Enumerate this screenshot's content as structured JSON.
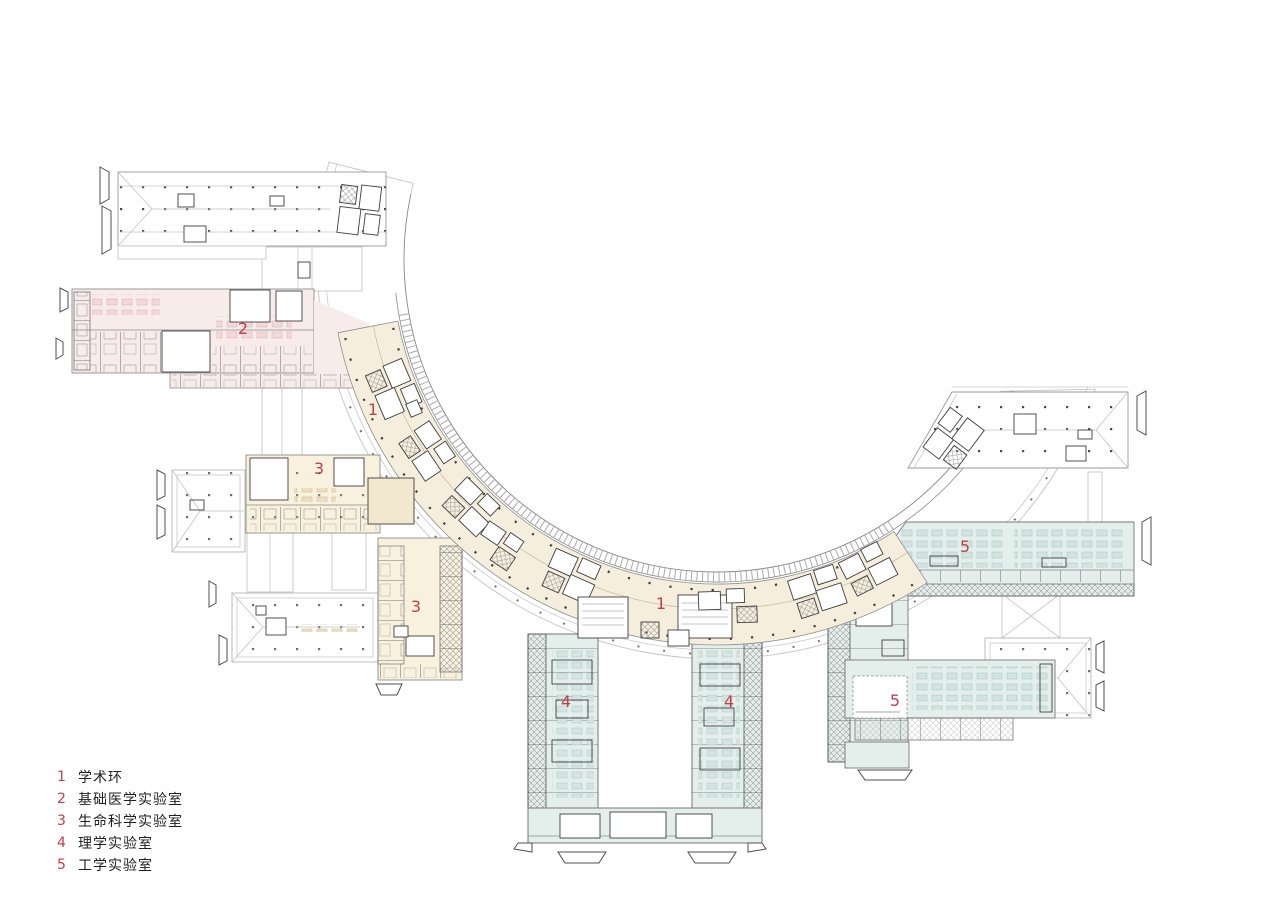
{
  "document": {
    "type": "architectural-floor-plan",
    "description": "campus laboratory complex plan with circular academic ring"
  },
  "colors": {
    "ring_fill": "#f6eedd",
    "wing2_fill": "#f8eceb",
    "wing3_fill": "#f7f1dd",
    "wing45_fill": "#e4efec",
    "accent_red": "#bc4249",
    "line_dark": "#3f3f3f",
    "line_mid": "#8a8a8a",
    "line_light": "#c9c9c9",
    "text_color": "#1f1f1f",
    "background": "#ffffff"
  },
  "legend": {
    "items": [
      {
        "num": "1",
        "label": "学术环"
      },
      {
        "num": "2",
        "label": "基础医学实验室"
      },
      {
        "num": "3",
        "label": "生命科学实验室"
      },
      {
        "num": "4",
        "label": "理学实验室"
      },
      {
        "num": "5",
        "label": "工学实验室"
      }
    ]
  },
  "plan_labels": [
    {
      "text": "1",
      "x": 373,
      "y": 410
    },
    {
      "text": "1",
      "x": 661,
      "y": 604
    },
    {
      "text": "2",
      "x": 243,
      "y": 329
    },
    {
      "text": "3",
      "x": 319,
      "y": 469
    },
    {
      "text": "3",
      "x": 416,
      "y": 607
    },
    {
      "text": "4",
      "x": 566,
      "y": 702
    },
    {
      "text": "4",
      "x": 729,
      "y": 702
    },
    {
      "text": "5",
      "x": 965,
      "y": 547
    },
    {
      "text": "5",
      "x": 895,
      "y": 701
    }
  ]
}
